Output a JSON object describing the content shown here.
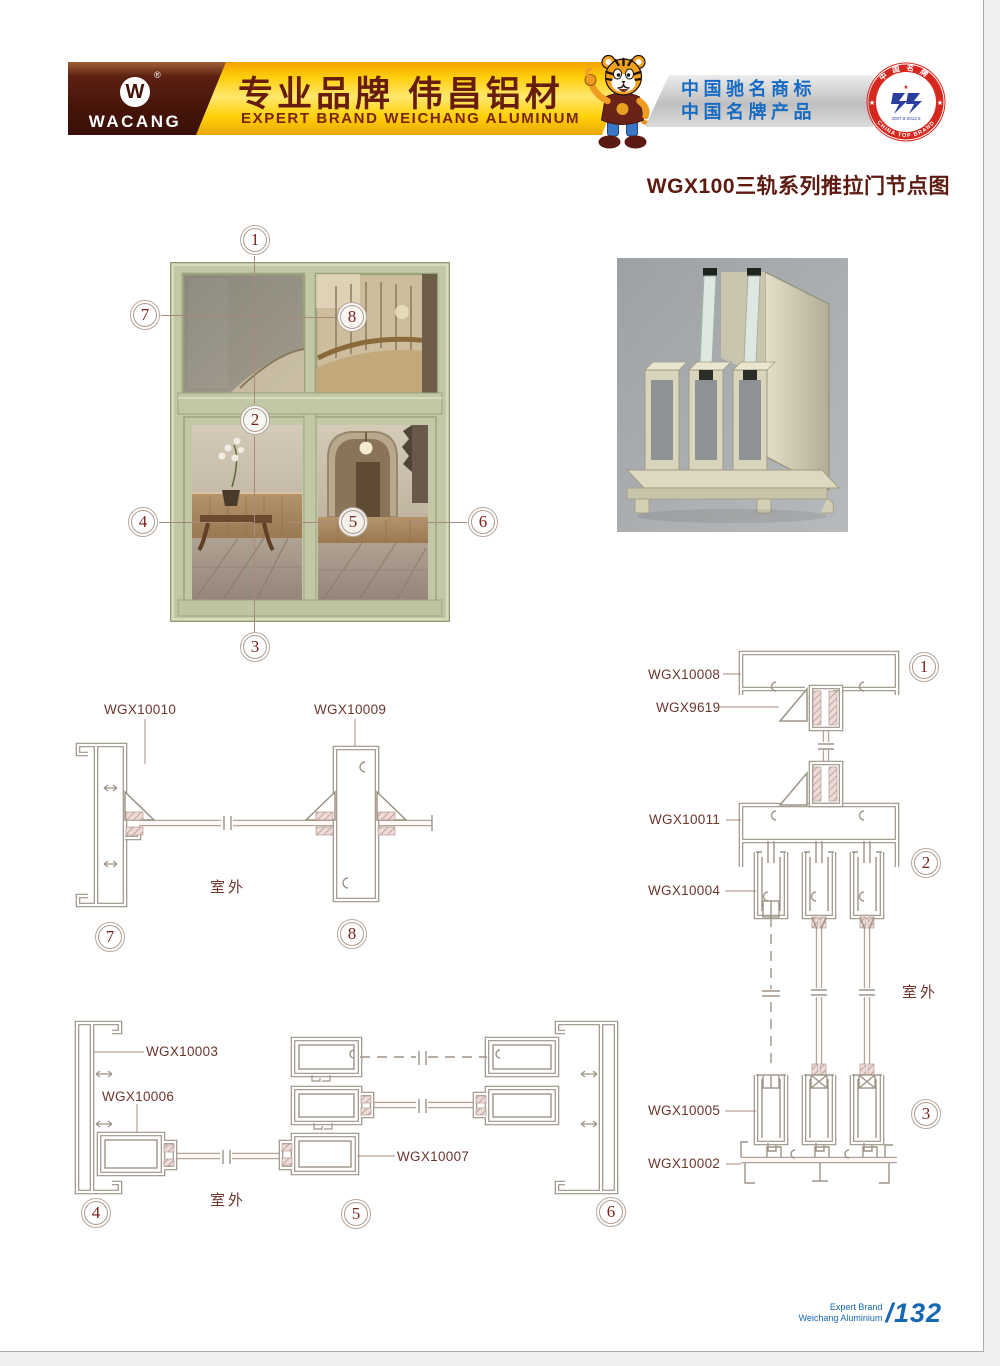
{
  "header": {
    "brand": "WACANG",
    "logo_letter": "W",
    "registered": "®",
    "slogan_cn": "专业品牌  伟昌铝材",
    "slogan_en": "EXPERT BRAND WEICHANG ALUMINUM",
    "honor_line1": "中国驰名商标",
    "honor_line2": "中国名牌产品",
    "seal": {
      "arc_top": "中国名牌",
      "arc_bottom": "CHINA TOP BRAND",
      "dates": "2007.9-2012.9"
    }
  },
  "title": "WGX100三轨系列推拉门节点图",
  "figure": {
    "callouts": {
      "c1": "1",
      "c2": "2",
      "c3": "3",
      "c4": "4",
      "c5": "5",
      "c6": "6",
      "c7": "7",
      "c8": "8"
    }
  },
  "drawing_a": {
    "label1": "WGX10010",
    "label2": "WGX10009",
    "outdoor": "室外",
    "callout1": "7",
    "callout2": "8"
  },
  "drawing_b": {
    "label1": "WGX10003",
    "label2": "WGX10006",
    "label3": "WGX10007",
    "outdoor": "室外",
    "callout1": "4",
    "callout2": "5",
    "callout3": "6"
  },
  "drawing_c": {
    "label1": "WGX10008",
    "label2": "WGX9619",
    "label3": "WGX10011",
    "label4": "WGX10004",
    "label5": "WGX10005",
    "label6": "WGX10002",
    "outdoor": "室外",
    "callout1": "1",
    "callout2": "2",
    "callout3": "3"
  },
  "footer": {
    "brand_line1": "Expert Brand",
    "brand_line2": "Weichang Aluminium",
    "page_number": "/132"
  },
  "colors": {
    "accent_maroon": "#5a1a12",
    "banner_yellow": "#ffd200",
    "honor_blue": "#176bc2",
    "seal_red": "#d6281e",
    "drawing_stroke": "#9d9386",
    "footer_blue": "#1668b3"
  }
}
